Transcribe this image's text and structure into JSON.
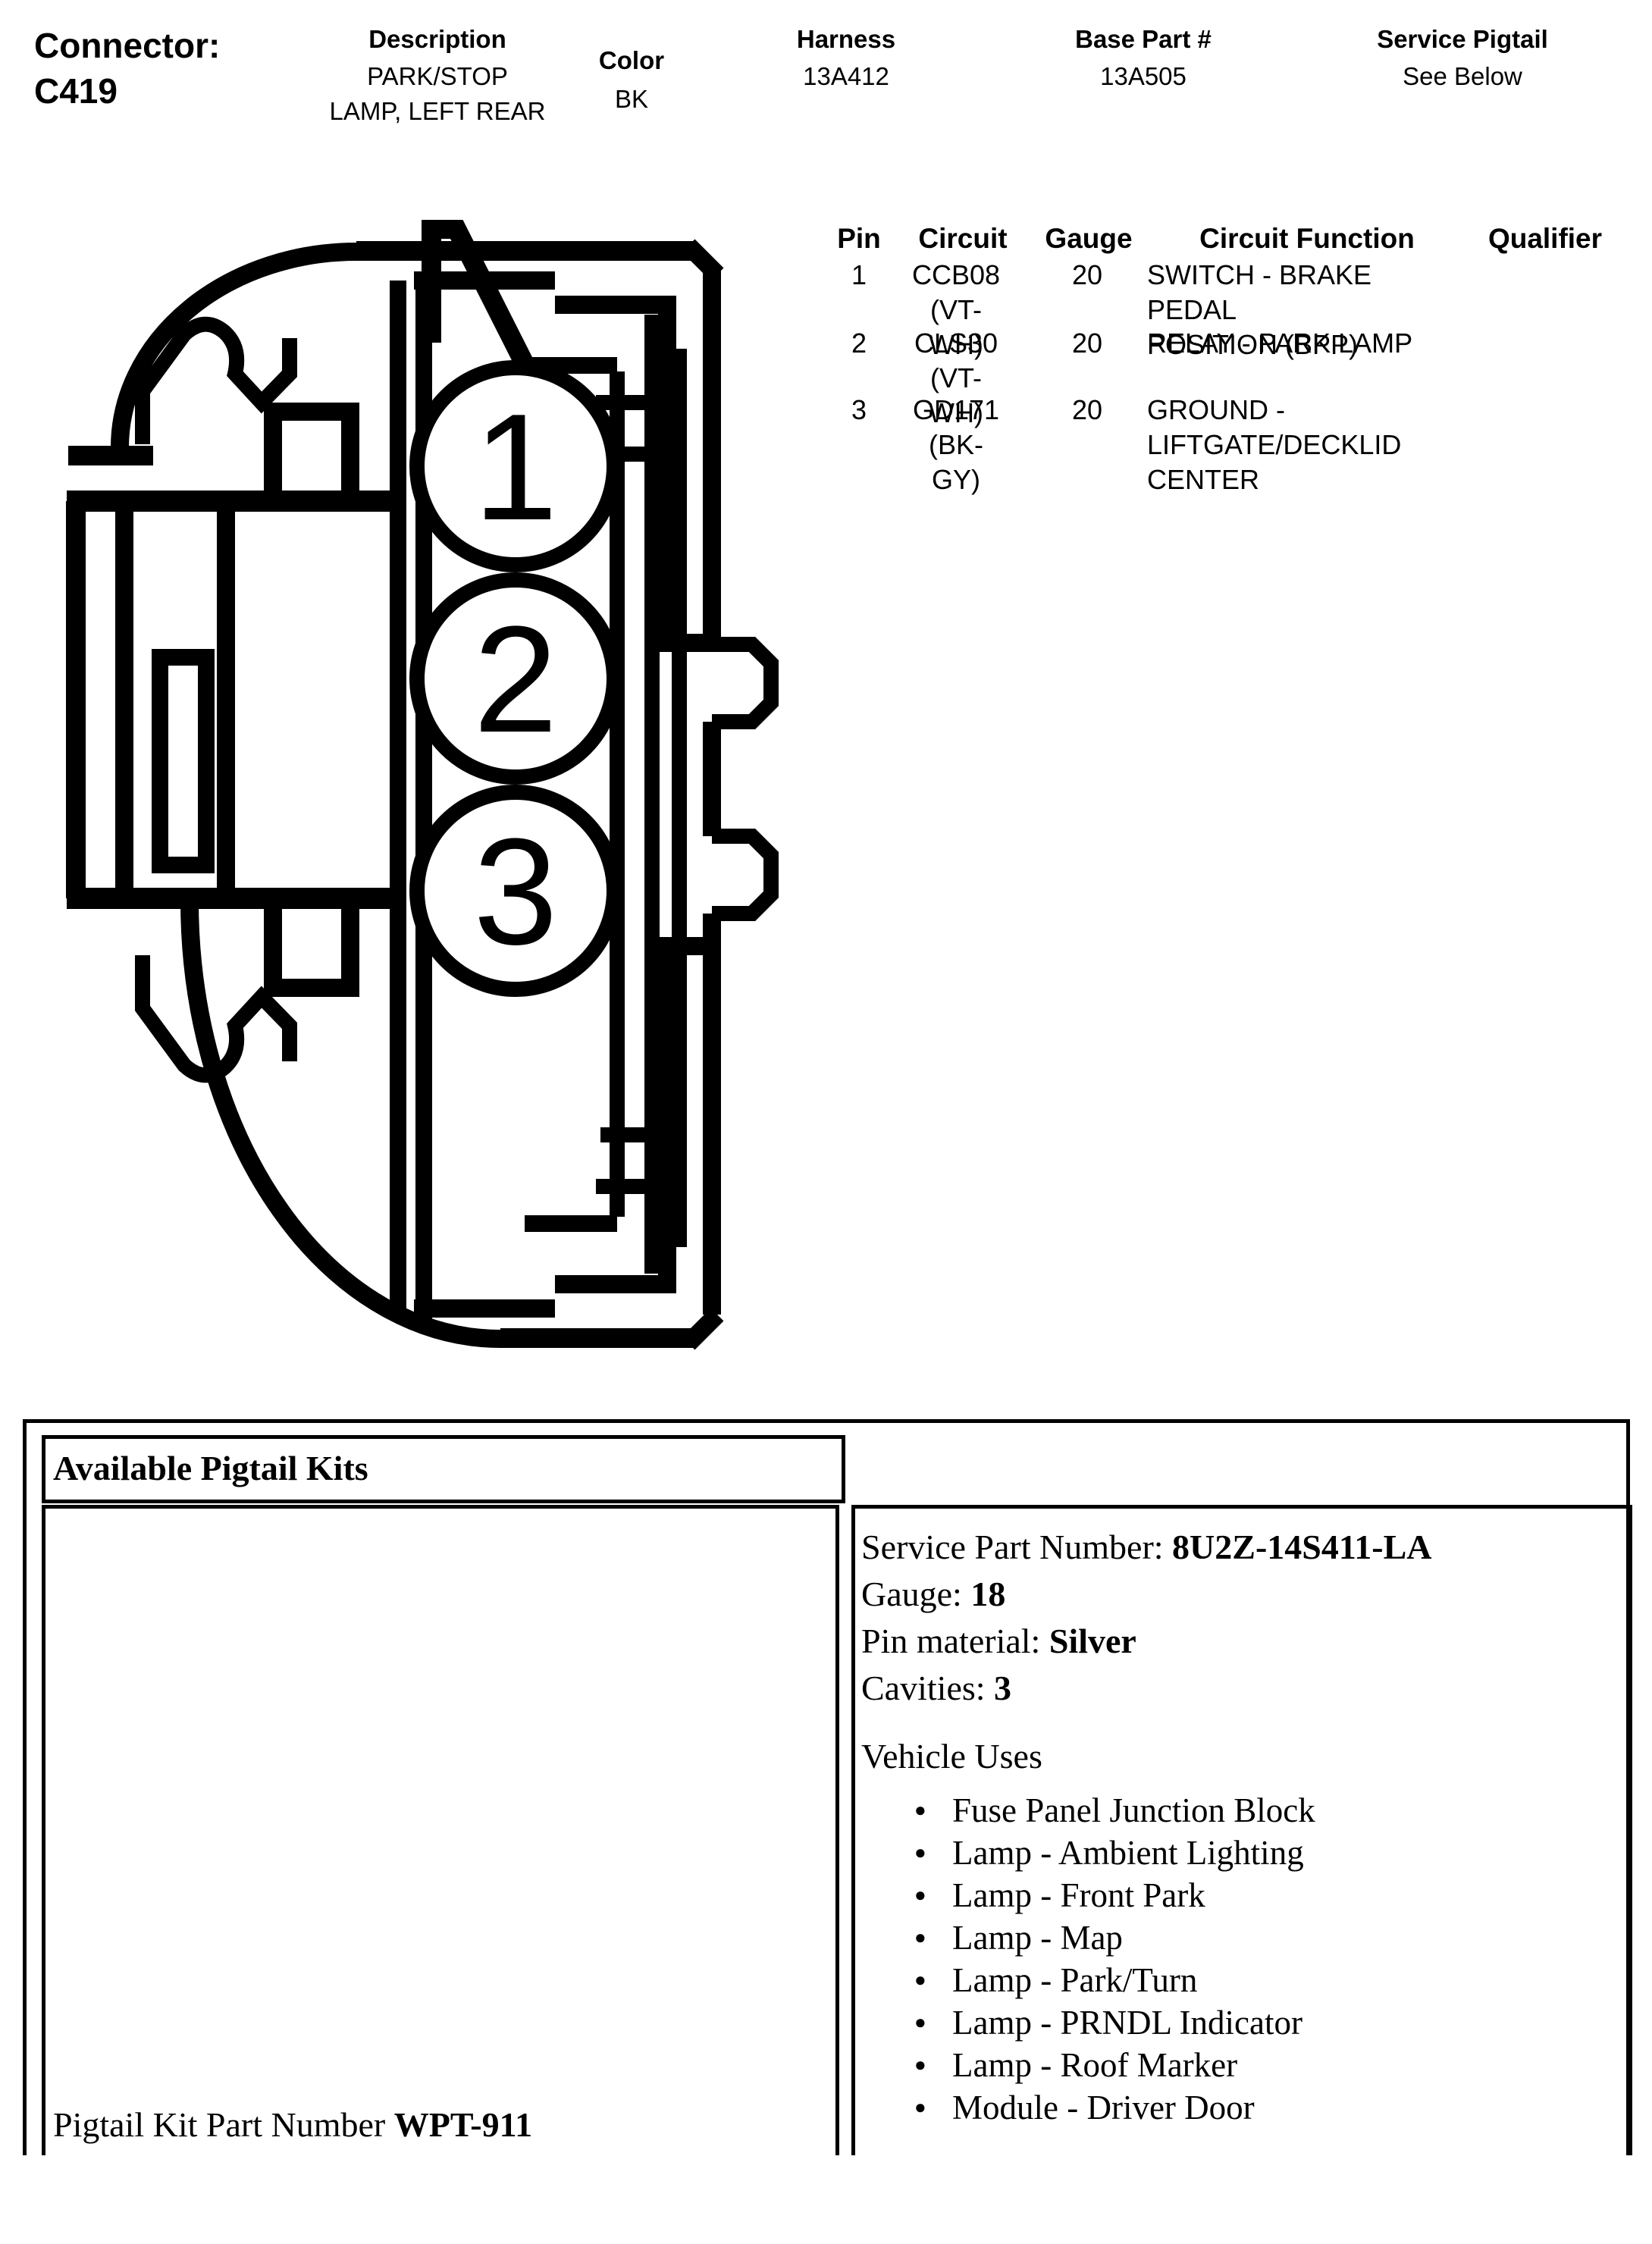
{
  "header": {
    "connector_label": "Connector:",
    "connector_id": "C419",
    "columns": [
      {
        "label": "Description",
        "value": "PARK/STOP\nLAMP, LEFT REAR"
      },
      {
        "label": "Color",
        "value": "BK"
      },
      {
        "label": "Harness",
        "value": "13A412"
      },
      {
        "label": "Base Part #",
        "value": "13A505"
      },
      {
        "label": "Service Pigtail",
        "value": "See Below"
      }
    ]
  },
  "pin_table": {
    "headers": {
      "pin": "Pin",
      "circuit": "Circuit",
      "gauge": "Gauge",
      "function": "Circuit Function",
      "qualifier": "Qualifier"
    },
    "rows": [
      {
        "pin": "1",
        "circuit": "CCB08 (VT-\nWH)",
        "gauge": "20",
        "function": "SWITCH - BRAKE PEDAL\nPOSITION (BPP)",
        "qualifier": ""
      },
      {
        "pin": "2",
        "circuit": "CLS30 (VT-\nWH)",
        "gauge": "20",
        "function": "RELAY - PARK LAMP",
        "qualifier": ""
      },
      {
        "pin": "3",
        "circuit": "GD171 (BK-\nGY)",
        "gauge": "20",
        "function": "GROUND -\nLIFTGATE/DECKLID\nCENTER",
        "qualifier": ""
      }
    ]
  },
  "diagram": {
    "pin_labels": [
      "1",
      "2",
      "3"
    ],
    "line_color": "#000000"
  },
  "pigtail_section": {
    "title": "Available Pigtail Kits",
    "kit_part_label": "Pigtail Kit Part Number ",
    "kit_part_number": "WPT-911",
    "details": [
      {
        "label": "Service Part Number: ",
        "value": "8U2Z-14S411-LA"
      },
      {
        "label": "Gauge: ",
        "value": "18"
      },
      {
        "label": "Pin material: ",
        "value": "Silver"
      },
      {
        "label": "Cavities: ",
        "value": "3"
      }
    ],
    "vehicle_uses_label": "Vehicle Uses",
    "vehicle_uses": [
      "Fuse Panel Junction Block",
      "Lamp - Ambient Lighting",
      "Lamp - Front Park",
      "Lamp - Map",
      "Lamp - Park/Turn",
      "Lamp - PRNDL Indicator",
      "Lamp - Roof Marker",
      "Module - Driver Door"
    ]
  }
}
